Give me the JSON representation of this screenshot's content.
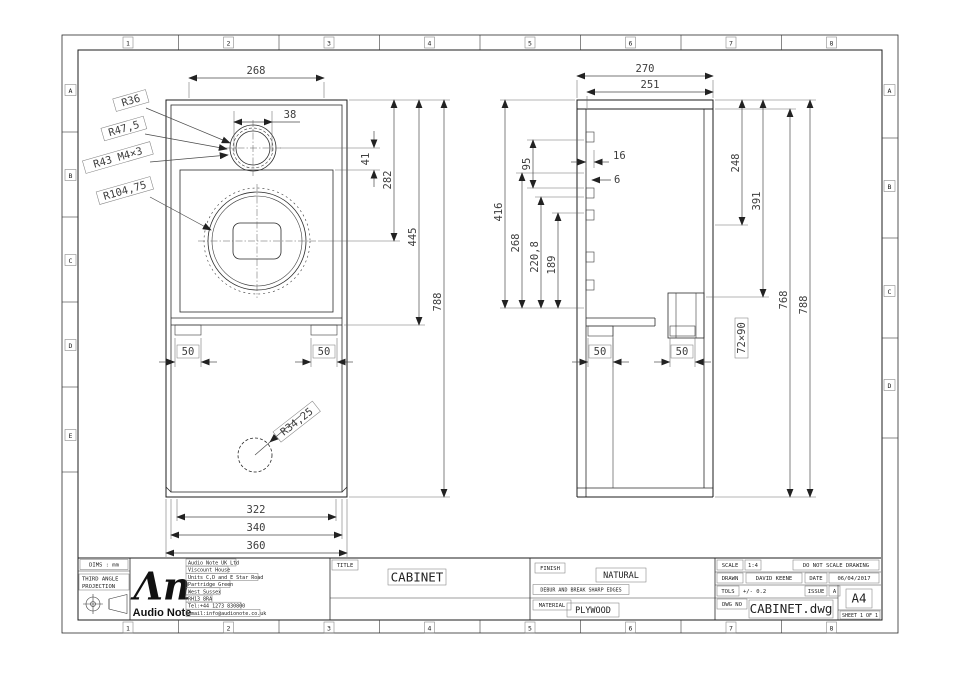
{
  "sheet": {
    "zone_numbers": [
      "1",
      "2",
      "3",
      "4",
      "5",
      "6",
      "7",
      "8"
    ],
    "zone_letters": [
      "A",
      "B",
      "C",
      "D",
      "E"
    ]
  },
  "front_view": {
    "dims": {
      "inner_width": "268",
      "tweeter_width": "38",
      "tweeter_offset": "41",
      "mid_height": "282",
      "shelf_height": "445",
      "height": "788",
      "batten_left": "50",
      "batten_right": "50",
      "bottom_inner": "322",
      "bottom_mid": "340",
      "bottom_outer": "360"
    },
    "labels": {
      "tweeter_r36": "R36",
      "tweeter_r47_5": "R47,5",
      "tweeter_bolts": "R43 M4×3",
      "woofer_radius": "R104,75",
      "port_radius": "R34,25"
    }
  },
  "side_view": {
    "dims": {
      "depth_outer": "270",
      "depth_inner": "251",
      "brace_window": "95",
      "brace_depth": "16",
      "gap": "6",
      "chamber": "416",
      "h268": "268",
      "h220_8": "220,8",
      "h189": "189",
      "h248": "248",
      "h391": "391",
      "inner_height": "768",
      "height": "788",
      "recess": "72×90",
      "batten_left": "50",
      "batten_right": "50"
    }
  },
  "title_block": {
    "dims_units": "DIMS : mm",
    "projection_line1": "THIRD ANGLE",
    "projection_line2": "PROJECTION",
    "logo_glyph": "Λn",
    "logo_text": "Audio Note",
    "address": [
      "Audio Note UK Ltd",
      "Viscount House",
      "Units C,D and E Star Road",
      "Partridge Green",
      "West Sussex",
      "RH13 8RA",
      "Tel:+44 1273 830800",
      "email:info@audionote.co.uk"
    ],
    "title_label": "TITLE",
    "title": "CABINET",
    "finish_label": "FINISH",
    "finish": "NATURAL",
    "edges_note": "DEBUR AND BREAK SHARP EDGES",
    "material_label": "MATERIAL",
    "material": "PLYWOOD",
    "scale_label": "SCALE",
    "scale": "1:4",
    "no_scale_note": "DO NOT SCALE DRAWING",
    "drawn_label": "DRAWN",
    "drawn": "DAVID KEENE",
    "date_label": "DATE",
    "date": "06/04/2017",
    "tols_label": "TOLS",
    "tols": "+/- 0.2",
    "issue_label": "ISSUE",
    "issue": "A",
    "dwg_no_label": "DWG NO",
    "dwg_file": "CABINET.dwg",
    "paper_size": "A4",
    "sheet_no": "SHEET 1 OF 1"
  }
}
